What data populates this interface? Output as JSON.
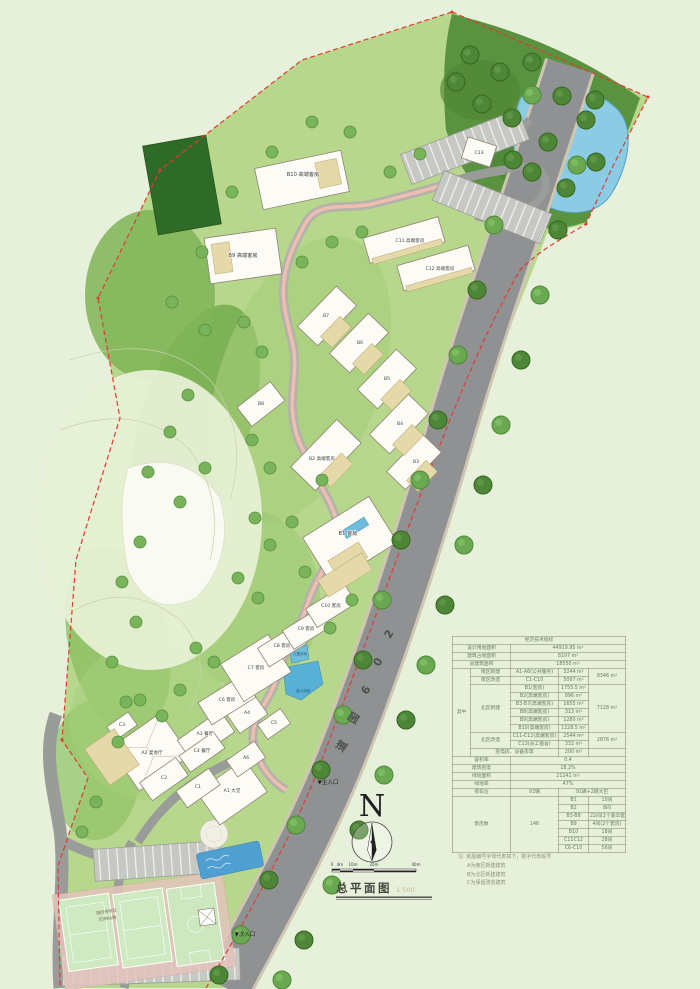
{
  "colors": {
    "background": "#e6f0da",
    "site_green": "#b7d78c",
    "forest_green": "#4e8637",
    "road_gray": "#8f9192",
    "water_blue": "#8ccbe4",
    "boundary_red": "#e23b2e",
    "building_fill": "#fcfbf5",
    "annex_tan": "#e6d9a9"
  },
  "legend": {
    "title": "总平面图",
    "scale": "1:500",
    "north": "N"
  },
  "scale_bar": {
    "ticks": [
      "0",
      "4m",
      "10m",
      "20m",
      "40m"
    ]
  },
  "road": {
    "name": "206国道",
    "chars": [
      "2",
      "0",
      "6",
      "国",
      "道"
    ]
  },
  "entrances": {
    "main": "▼主入口",
    "secondary": "▼次入口"
  },
  "site": {
    "adult_pool": "成人泳池",
    "kids_pool": "儿童泳池",
    "temp_parking_line1": "临时停车区",
    "temp_parking_line2": "可停80辆"
  },
  "buildings": [
    {
      "id": "A1",
      "label": "A1 大堂"
    },
    {
      "id": "A2",
      "label": "A2 宴会厅"
    },
    {
      "id": "A3",
      "label": "A3 餐厅"
    },
    {
      "id": "A4",
      "label": "A4"
    },
    {
      "id": "A6",
      "label": "A6"
    },
    {
      "id": "C1",
      "label": "C1"
    },
    {
      "id": "C2",
      "label": "C2"
    },
    {
      "id": "C3",
      "label": "C3"
    },
    {
      "id": "C4",
      "label": "C4 餐厅"
    },
    {
      "id": "C5",
      "label": "C5"
    },
    {
      "id": "C6",
      "label": "C6 客房"
    },
    {
      "id": "C7",
      "label": "C7 客房"
    },
    {
      "id": "C8",
      "label": "C8 客房"
    },
    {
      "id": "C9",
      "label": "C9 客房"
    },
    {
      "id": "C10",
      "label": "C10 客房"
    },
    {
      "id": "B1",
      "label": "B1 客房"
    },
    {
      "id": "B2",
      "label": "B2 高端客房"
    },
    {
      "id": "B3",
      "label": "B3"
    },
    {
      "id": "B4",
      "label": "B4"
    },
    {
      "id": "B5",
      "label": "B5"
    },
    {
      "id": "B6",
      "label": "B6"
    },
    {
      "id": "B7",
      "label": "B7"
    },
    {
      "id": "B8",
      "label": "B8"
    },
    {
      "id": "B9",
      "label": "B9 高端客房"
    },
    {
      "id": "B10",
      "label": "B10 高端客房"
    },
    {
      "id": "C11",
      "label": "C11 高端客房"
    },
    {
      "id": "C12",
      "label": "C12 高端客房"
    },
    {
      "id": "C13",
      "label": "C13"
    }
  ],
  "table": {
    "header": "经济技术指标",
    "rows_top": [
      {
        "label": "设计用地面积",
        "value": "44919.95 m²"
      },
      {
        "label": "建筑占地面积",
        "value": "8197  m²"
      },
      {
        "label": "总建筑面积",
        "value": "18550  m²"
      }
    ],
    "mid_label": "其中",
    "breakdown": [
      {
        "zone": "南区新建",
        "item": "A1-A6(公共服务)",
        "area": "3244 m²",
        "subtotal": "8346 m²"
      },
      {
        "zone": "南区改造",
        "item": "C1-C10",
        "area": "5097 m²"
      },
      {
        "zone": "北区新建",
        "item": "B1(客房)",
        "area": "1755.5 m²",
        "subtotal": "7128 m²"
      },
      {
        "item": "B2(高端客房)",
        "area": "896  m²"
      },
      {
        "item": "B3-B7(高端客房)",
        "area": "1655  m²"
      },
      {
        "item": "B8(高端客房)",
        "area": "313  m²"
      },
      {
        "item": "B9(高端客房)",
        "area": "1280  m²"
      },
      {
        "item": "B10(高端客房)",
        "area": "1228.5 m²"
      },
      {
        "zone": "北区改造",
        "item": "C11-C12(高端客房)",
        "area": "2544 m²",
        "subtotal": "2876 m²"
      },
      {
        "item": "C13(员工宿舍)",
        "area": "332  m²"
      },
      {
        "zone": "变电房、设备房等",
        "area": "200  m²"
      }
    ],
    "rows_bottom": [
      {
        "label": "容积率",
        "value": "0.4"
      },
      {
        "label": "建筑密度",
        "value": "18.2%"
      },
      {
        "label": "绿地面积",
        "value": "21241  m²"
      },
      {
        "label": "绿地率",
        "value": "47%"
      }
    ],
    "parking": {
      "label": "停车位",
      "count": "93辆",
      "detail": "91辆+2辆大巴"
    },
    "rooms": {
      "label": "客房数",
      "total": "146",
      "items": [
        {
          "code": "B1",
          "num": "10间"
        },
        {
          "code": "B2",
          "num": "8间"
        },
        {
          "code": "B3-B8",
          "num": "22间(2个豪华套房)"
        },
        {
          "code": "B9",
          "num": "4间(2个套房)"
        },
        {
          "code": "B10",
          "num": "18间"
        },
        {
          "code": "C11C12",
          "num": "28间"
        },
        {
          "code": "C6-C10",
          "num": "56间"
        }
      ]
    }
  },
  "notes": {
    "line1": "注: 房屋编号字母代表如下，数字代表栋号",
    "line2": "A为南区新建建筑",
    "line3": "B为北区新建建筑",
    "line4": "C为保留改造建筑"
  }
}
